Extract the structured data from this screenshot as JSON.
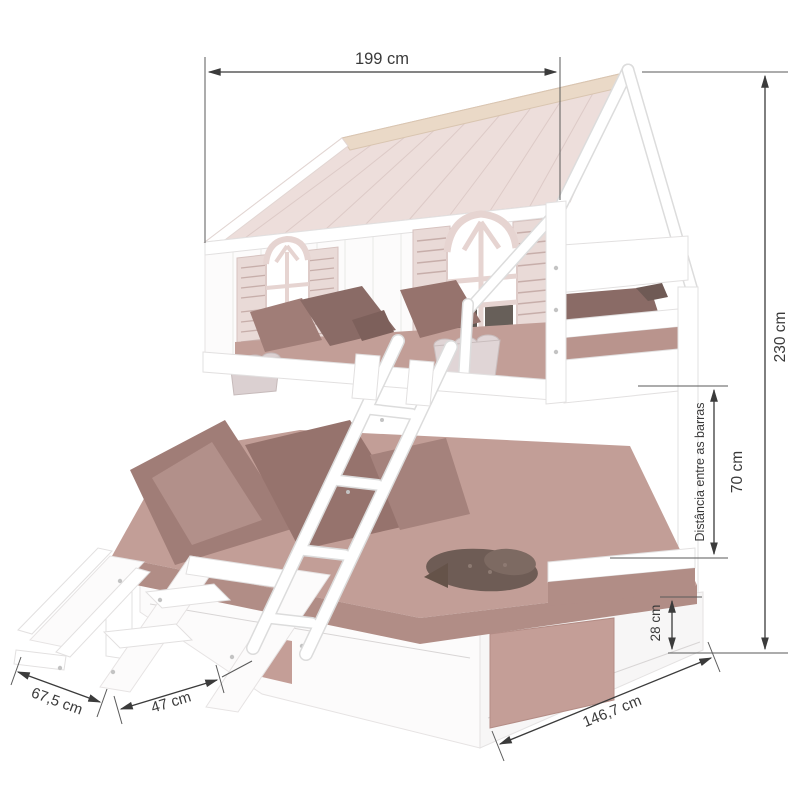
{
  "diagram": {
    "description": "Playhouse bunk bed with slide and stairs - dimension drawing",
    "dimensions": {
      "top_width": "199 cm",
      "right_height": "230 cm",
      "bars_gap_caption": "Distância entre as barras",
      "bars_gap_value": "70 cm",
      "leg_height": "28 cm",
      "slide_footprint": "67,5 cm",
      "stairs_footprint": "47 cm",
      "side_depth": "146,7 cm"
    },
    "colors": {
      "roof_pink": "#eddedb",
      "roof_ridge_cream": "#ead9c7",
      "wall_white": "#fcfbfb",
      "shutter_pink": "#e9dad7",
      "window_frame_pink": "#e6d4d1",
      "window_interior_dark": "#5f5751",
      "bedding_mauve": "#c29e97",
      "bedding_shadow": "#b18d86",
      "pillow_dark": "#96736d",
      "plush_taupe": "#6e5c55",
      "dimension_line": "#3b3b3b"
    }
  }
}
